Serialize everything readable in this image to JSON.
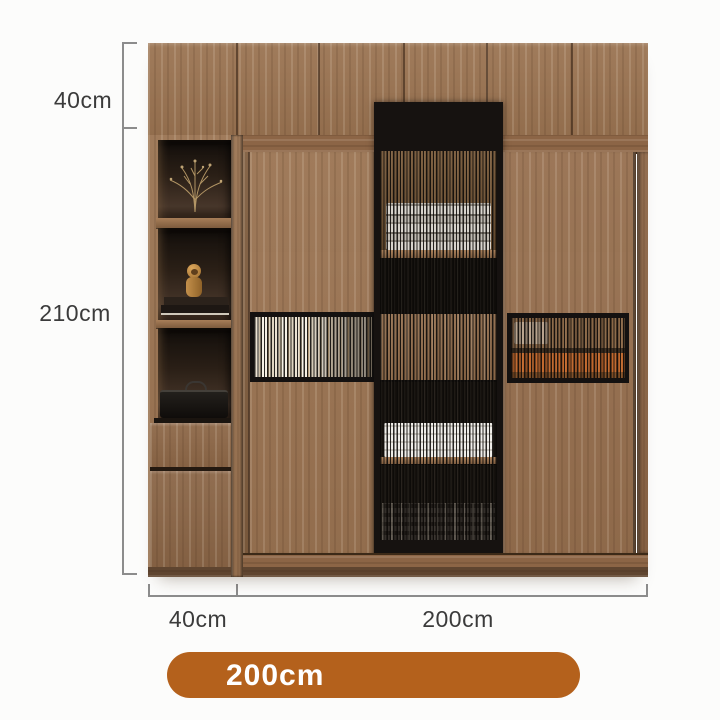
{
  "labels": {
    "top_section_height": "40cm",
    "main_section_height": "210cm",
    "side_unit_width": "40cm",
    "sliding_section_width": "200cm"
  },
  "badge": {
    "label": "200cm"
  },
  "colors": {
    "badge_background": "#b4611c",
    "badge_text": "#ffffff",
    "dimension_line": "#8c8c8c",
    "label_text": "#3b3b3b",
    "wood_main": "#9a7351",
    "wood_dark_base": "#6b4e36",
    "glass_frame_black": "#161210",
    "contents_orange": "#c0662b",
    "background": "#fcfcfb"
  },
  "furniture": {
    "type": "wardrobe-with-sliding-doors",
    "top_row_doors": 6,
    "side_unit": [
      "open-cubby-flowers",
      "open-cubby-figurine-books",
      "open-cubby-bag",
      "drawer",
      "drawer"
    ],
    "sliding_doors": [
      "wood-door-with-glass-strip",
      "fluted-glass-door",
      "wood-door-with-glass-strip"
    ]
  }
}
